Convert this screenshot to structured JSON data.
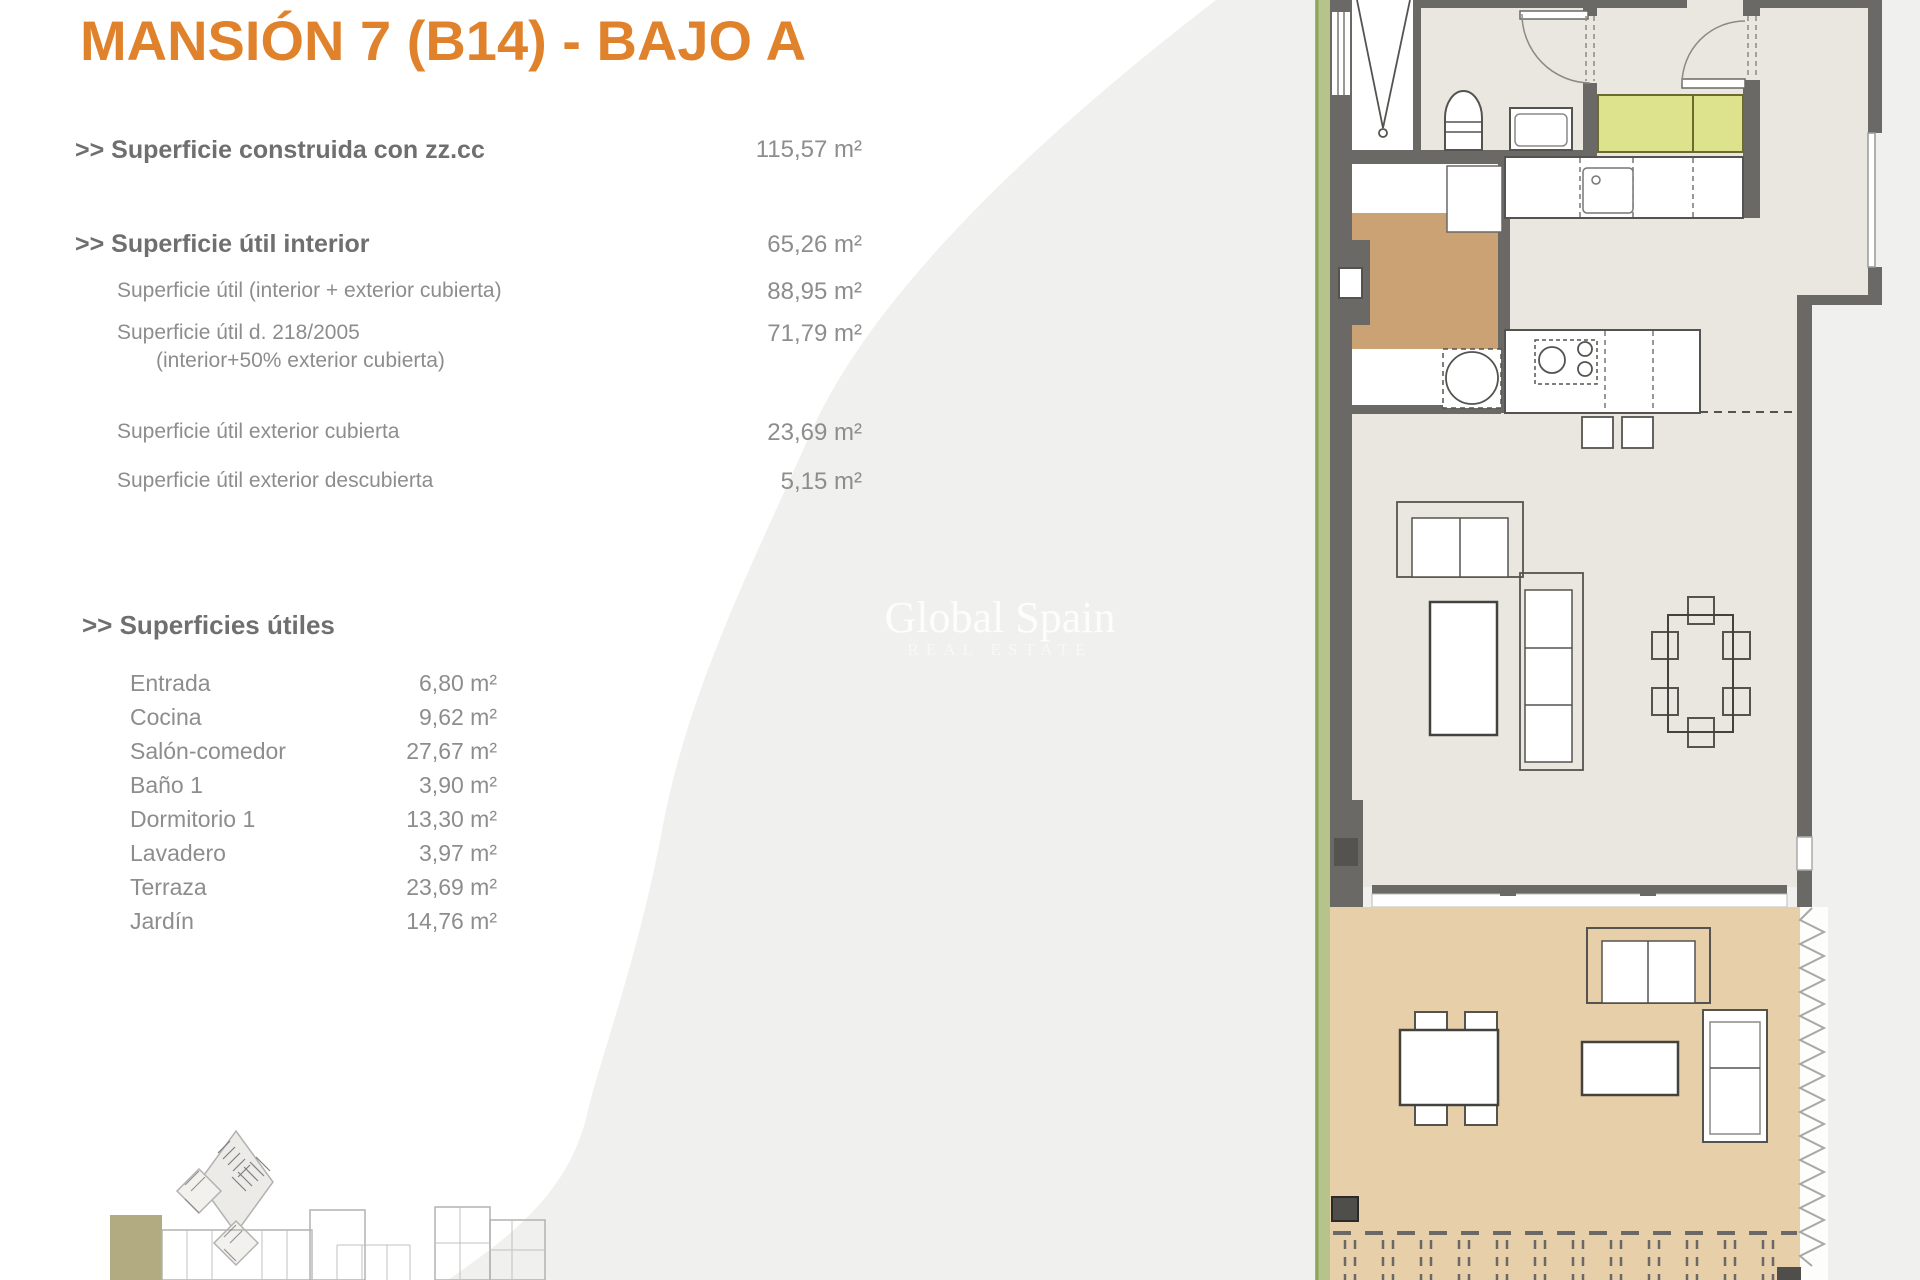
{
  "title": "MANSIÓN 7 (B14) - BAJO A",
  "summary": {
    "construida": {
      "label": ">> Superficie construida con zz.cc",
      "value": "115,57 m²"
    },
    "util_interior": {
      "label": ">> Superficie útil interior",
      "value": "65,26 m²"
    },
    "util_int_ext": {
      "label": "Superficie útil (interior + exterior cubierta)",
      "value": "88,95 m²"
    },
    "util_218": {
      "label": "Superficie útil  d. 218/2005",
      "sublabel": "(interior+50% exterior cubierta)",
      "value": "71,79 m²"
    },
    "ext_cubierta": {
      "label": "Superficie útil exterior cubierta",
      "value": "23,69 m²"
    },
    "ext_descubierta": {
      "label": "Superficie útil exterior descubierta",
      "value": "5,15 m²"
    }
  },
  "rooms_header": ">> Superficies útiles",
  "rooms": [
    {
      "name": "Entrada",
      "value": "6,80 m²"
    },
    {
      "name": "Cocina",
      "value": "9,62 m²"
    },
    {
      "name": "Salón-comedor",
      "value": "27,67 m²"
    },
    {
      "name": "Baño 1",
      "value": "3,90 m²"
    },
    {
      "name": "Dormitorio 1",
      "value": "13,30 m²"
    },
    {
      "name": "Lavadero",
      "value": "3,97 m²"
    },
    {
      "name": "Terraza",
      "value": "23,69 m²"
    },
    {
      "name": "Jardín",
      "value": "14,76 m²"
    }
  ],
  "watermark": {
    "line1": "Global Spain",
    "line2": "REAL ESTATE"
  },
  "colors": {
    "accent_orange": "#e0822b",
    "text_bold_gray": "#6f6f6f",
    "text_gray": "#8d8d8d",
    "background_shade": "#f0f0ee",
    "plan_wall": "#6b6965",
    "plan_floor": "#eae7e1",
    "plan_entry_floor": "#cba273",
    "plan_kitchen_counter": "#dde28c",
    "plan_terrace_floor": "#e7cfa9",
    "plan_garden_strip": "#b6c38b",
    "siteplan_highlight": "#b2aa81"
  }
}
